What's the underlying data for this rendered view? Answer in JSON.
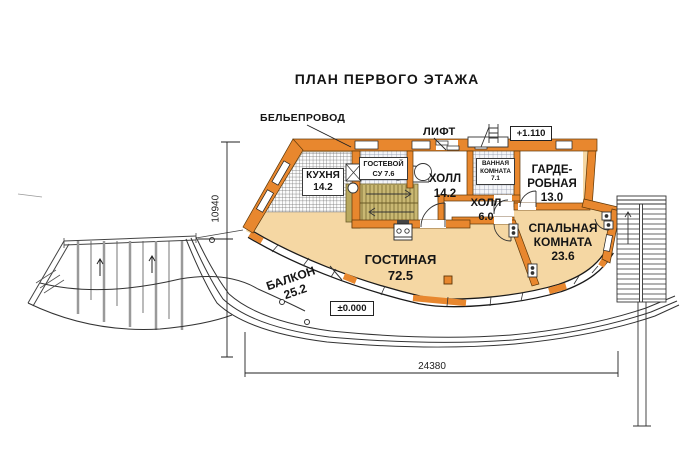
{
  "title": "ПЛАН ПЕРВОГО ЭТАЖА",
  "annotations": {
    "laundry_chute": "БЕЛЬЕПРОВОД",
    "elevator": "ЛИФТ",
    "level_upper": "+1.110",
    "level_zero": "±0.000"
  },
  "dimensions": {
    "height_mm": "10940",
    "width_mm": "24380"
  },
  "rooms": {
    "kitchen": {
      "lines": [
        "КУХНЯ",
        "14.2"
      ]
    },
    "guest_wc": {
      "lines": [
        "ГОСТЕВОЙ",
        "СУ 7.6"
      ]
    },
    "hall_main": {
      "lines": [
        "ХОЛЛ",
        "14.2"
      ]
    },
    "bathroom": {
      "lines": [
        "ВАННАЯ",
        "КОМНАТА",
        "7.1"
      ]
    },
    "wardrobe": {
      "lines": [
        "ГАРДЕ-",
        "РОБНАЯ",
        "13.0"
      ]
    },
    "hall_small": {
      "lines": [
        "ХОЛЛ",
        "6.0"
      ]
    },
    "living": {
      "lines": [
        "ГОСТИНАЯ",
        "72.5"
      ]
    },
    "bedroom": {
      "lines": [
        "СПАЛЬНАЯ",
        "КОМНАТА",
        "23.6"
      ]
    },
    "balcony": {
      "lines": [
        "БАЛКОН",
        "25.2"
      ]
    }
  },
  "colors": {
    "wall_orange": "#E8872E",
    "floor_tan": "#F5D7A3",
    "stairs_khaki": "#C9B873",
    "line_dark": "#222222"
  }
}
